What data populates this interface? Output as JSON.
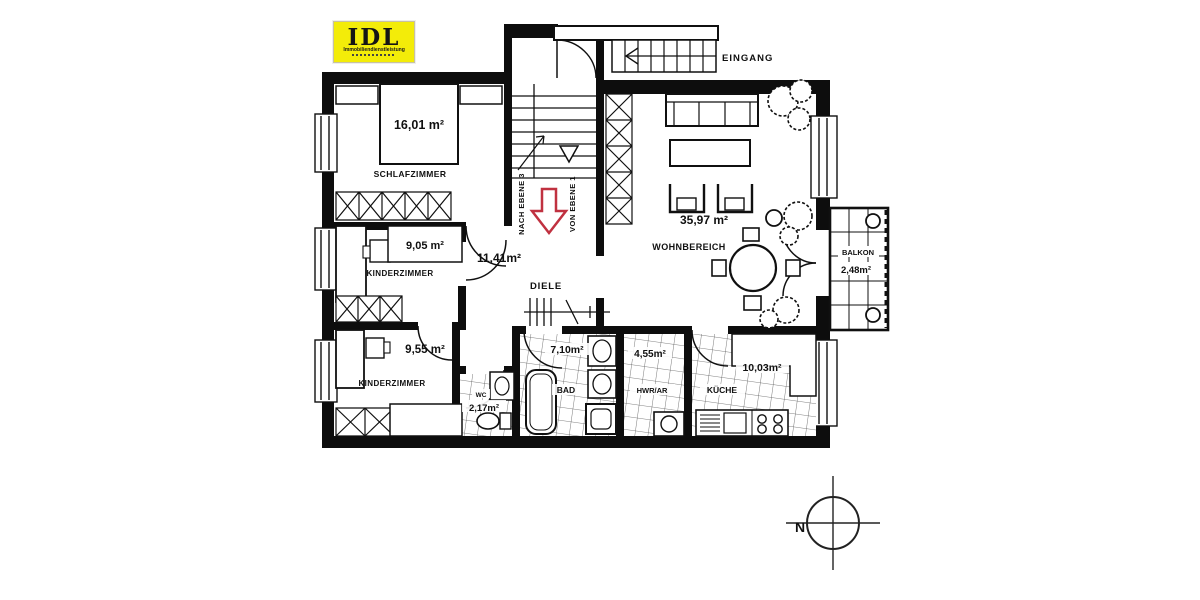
{
  "logo": {
    "title": "IDL",
    "subtitle": "Immobiliendienstleistung"
  },
  "stairwell": {
    "entrance_label": "EINGANG",
    "to_upper_level": "NACH EBENE 3",
    "from_lower_level": "VON EBENE 1"
  },
  "compass": {
    "north": "N"
  },
  "rooms": {
    "schlafzimmer": {
      "name": "SCHLAFZIMMER",
      "area": "16,01 m²"
    },
    "kinderzimmer1": {
      "name": "KINDERZIMMER",
      "area": "9,05 m²"
    },
    "kinderzimmer2": {
      "name": "KINDERZIMMER",
      "area": "9,55 m²"
    },
    "diele": {
      "name": "DIELE",
      "area": "11,41m²"
    },
    "wohnbereich": {
      "name": "WOHNBEREICH",
      "area": "35,97 m²"
    },
    "balkon": {
      "name": "BALKON",
      "area": "2,48m²"
    },
    "bad": {
      "name": "BAD",
      "area": "7,10m²"
    },
    "wc": {
      "name": "WC",
      "area": "2,17m²"
    },
    "hwr": {
      "name": "HWR/AR",
      "area": "4,55m²"
    },
    "kueche": {
      "name": "KÜCHE",
      "area": "10,03m²"
    }
  },
  "colors": {
    "wall": "#0d0d0d",
    "logo_bg": "#f3ec09",
    "arrow_red": "#c03140",
    "paper": "#ffffff"
  }
}
